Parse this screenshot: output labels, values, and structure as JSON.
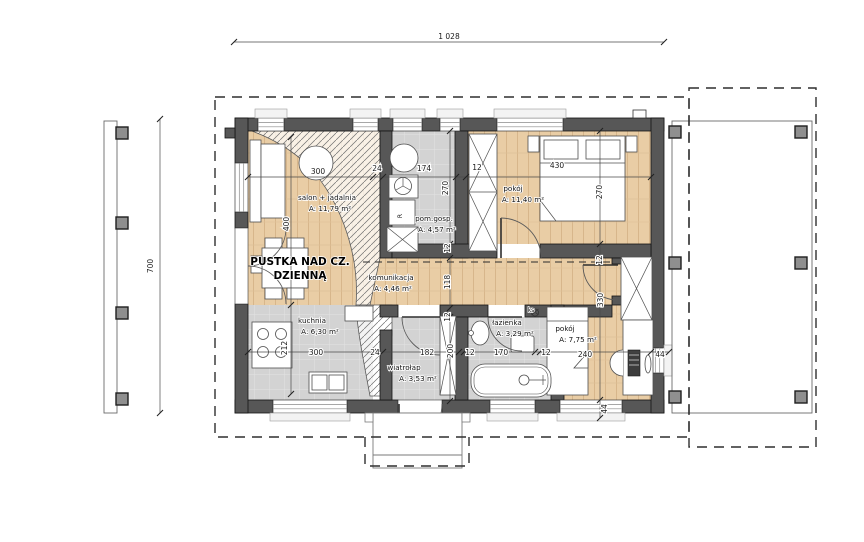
{
  "drawing": {
    "type": "house-floor-plan",
    "overall_width_label": "1 028",
    "overall_height_label": "700",
    "void_note": [
      "PUSTKA NAD CZ.",
      "DZIENNĄ"
    ],
    "colors": {
      "wall": "#575757",
      "wood_floor": "#e9cda5",
      "tile_floor": "#d3d3d3"
    }
  },
  "rooms": [
    {
      "name": "salon + jadalnia",
      "area": "A: 11,79 m²"
    },
    {
      "name": "pom.gosp.",
      "area": "A: 4,57 m²"
    },
    {
      "name": "pokój",
      "area": "A: 11,40 m²"
    },
    {
      "name": "komunikacja",
      "area": "A: 4,46 m²"
    },
    {
      "name": "kuchnia",
      "area": "A: 6,30 m²"
    },
    {
      "name": "łazienka",
      "area": "A: 3,29 m²"
    },
    {
      "name": "pokój",
      "area": "A: 7,75 m²"
    },
    {
      "name": "wiatrołap",
      "area": "A: 3,53 m²"
    }
  ],
  "labels": [
    {
      "t": "salon + jadalnia",
      "x": 327,
      "y": 200,
      "cls": "room",
      "n": "room-label-salon"
    },
    {
      "t": "A: 11,79 m²",
      "x": 330,
      "y": 211,
      "cls": "room",
      "n": "room-area-salon"
    },
    {
      "t": "pom.gosp.",
      "x": 434,
      "y": 221,
      "cls": "room",
      "n": "room-label-pom-gosp"
    },
    {
      "t": "A: 4,57 m²",
      "x": 437,
      "y": 232,
      "cls": "room",
      "n": "room-area-pom-gosp"
    },
    {
      "t": "pokój",
      "x": 513,
      "y": 191,
      "cls": "room",
      "n": "room-label-pokoj-1"
    },
    {
      "t": "A: 11,40 m²",
      "x": 523,
      "y": 202,
      "cls": "room",
      "n": "room-area-pokoj-1"
    },
    {
      "t": "komunikacja",
      "x": 391,
      "y": 280,
      "cls": "room",
      "n": "room-label-komunikacja"
    },
    {
      "t": "A: 4,46 m²",
      "x": 393,
      "y": 291,
      "cls": "room",
      "n": "room-area-komunikacja"
    },
    {
      "t": "kuchnia",
      "x": 312,
      "y": 323,
      "cls": "room",
      "n": "room-label-kuchnia"
    },
    {
      "t": "A: 6,30 m²",
      "x": 320,
      "y": 334,
      "cls": "room",
      "n": "room-area-kuchnia"
    },
    {
      "t": "łazienka",
      "x": 507,
      "y": 325,
      "cls": "room",
      "n": "room-label-lazienka"
    },
    {
      "t": "A: 3,29 m²",
      "x": 515,
      "y": 336,
      "cls": "room",
      "n": "room-area-lazienka"
    },
    {
      "t": "pokój",
      "x": 565,
      "y": 331,
      "cls": "room",
      "n": "room-label-pokoj-2"
    },
    {
      "t": "A: 7,75 m²",
      "x": 578,
      "y": 342,
      "cls": "room",
      "n": "room-area-pokoj-2"
    },
    {
      "t": "wiatrołap",
      "x": 404,
      "y": 370,
      "cls": "room",
      "n": "room-label-wiatrolap"
    },
    {
      "t": "A: 3,53 m²",
      "x": 418,
      "y": 381,
      "cls": "room",
      "n": "room-area-wiatrolap"
    },
    {
      "t": "PUSTKA NAD CZ.",
      "x": 300,
      "y": 265,
      "cls": "pustka",
      "n": "void-label-line1"
    },
    {
      "t": "DZIENNĄ",
      "x": 300,
      "y": 279,
      "cls": "pustka",
      "n": "void-label-line2"
    },
    {
      "t": "ks",
      "x": 531,
      "y": 312,
      "cls": "tiny",
      "n": "ks-label"
    },
    {
      "t": "R",
      "x": 402,
      "y": 216,
      "cls": "tiny",
      "r": -90,
      "n": "appliance-r-label"
    },
    {
      "t": "300",
      "x": 318,
      "y": 174,
      "cls": "dim",
      "n": "dim-300-top"
    },
    {
      "t": "24",
      "x": 377,
      "y": 171,
      "cls": "dim",
      "n": "dim-24-top"
    },
    {
      "t": "174",
      "x": 424,
      "y": 171,
      "cls": "dim",
      "n": "dim-174"
    },
    {
      "t": "12",
      "x": 477,
      "y": 170,
      "cls": "dim",
      "n": "dim-12-top"
    },
    {
      "t": "430",
      "x": 557,
      "y": 168,
      "cls": "dim",
      "n": "dim-430"
    },
    {
      "t": "400",
      "x": 289,
      "y": 224,
      "r": -90,
      "cls": "dim",
      "n": "dim-400"
    },
    {
      "t": "212",
      "x": 287,
      "y": 348,
      "r": -90,
      "cls": "dim",
      "n": "dim-212"
    },
    {
      "t": "270",
      "x": 448,
      "y": 188,
      "r": -90,
      "cls": "dim",
      "n": "dim-270-left"
    },
    {
      "t": "12",
      "x": 450,
      "y": 248,
      "r": -90,
      "cls": "dim",
      "n": "dim-12-mid1"
    },
    {
      "t": "118",
      "x": 450,
      "y": 282,
      "r": -90,
      "cls": "dim",
      "n": "dim-118"
    },
    {
      "t": "12",
      "x": 450,
      "y": 317,
      "r": -90,
      "cls": "dim",
      "n": "dim-12-mid2"
    },
    {
      "t": "200",
      "x": 453,
      "y": 351,
      "r": -90,
      "cls": "dim",
      "n": "dim-200"
    },
    {
      "t": "270",
      "x": 602,
      "y": 192,
      "r": -90,
      "cls": "dim",
      "n": "dim-270-right"
    },
    {
      "t": "12",
      "x": 602,
      "y": 260,
      "r": -90,
      "cls": "dim",
      "n": "dim-12-right"
    },
    {
      "t": "330",
      "x": 603,
      "y": 300,
      "r": -90,
      "cls": "dim",
      "n": "dim-330"
    },
    {
      "t": "44",
      "x": 607,
      "y": 409,
      "r": -90,
      "cls": "dim",
      "n": "dim-44-bottom"
    },
    {
      "t": "300",
      "x": 316,
      "y": 355,
      "cls": "dim",
      "n": "dim-300-bot"
    },
    {
      "t": "24",
      "x": 375,
      "y": 355,
      "cls": "dim",
      "n": "dim-24-bot"
    },
    {
      "t": "182",
      "x": 427,
      "y": 355,
      "cls": "dim",
      "n": "dim-182"
    },
    {
      "t": "12",
      "x": 470,
      "y": 355,
      "cls": "dim",
      "n": "dim-12-bot1"
    },
    {
      "t": "170",
      "x": 501,
      "y": 355,
      "cls": "dim",
      "n": "dim-170"
    },
    {
      "t": "12",
      "x": 546,
      "y": 355,
      "cls": "dim",
      "n": "dim-12-bot2"
    },
    {
      "t": "240",
      "x": 585,
      "y": 357,
      "cls": "dim",
      "n": "dim-240"
    },
    {
      "t": "44",
      "x": 660,
      "y": 357,
      "cls": "dim",
      "n": "dim-44-right"
    }
  ]
}
